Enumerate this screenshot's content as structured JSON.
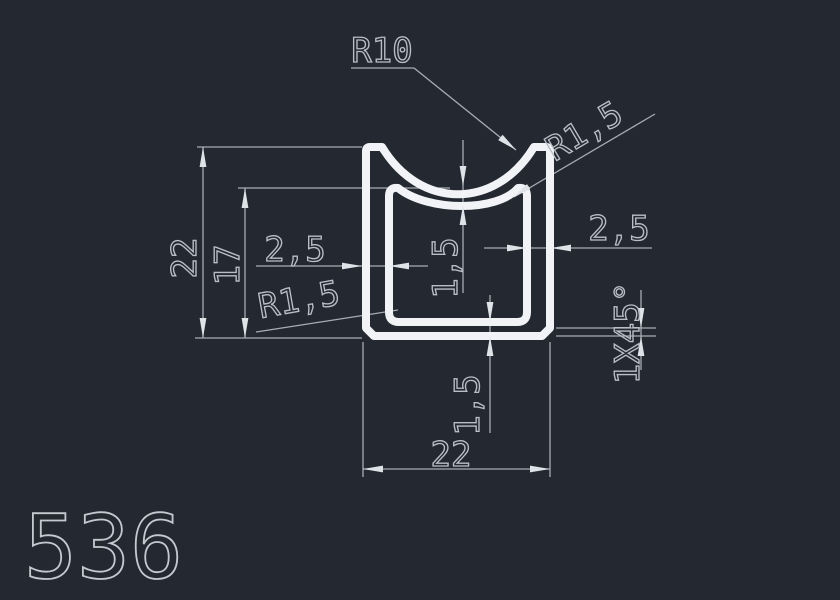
{
  "drawing": {
    "profile_number": "536",
    "dims": {
      "radius_saddle": "R10",
      "radius_top_right": "R1,5",
      "radius_bottom_left": "R1,5",
      "wall_left": "2,5",
      "wall_right": "2,5",
      "height_total": "22",
      "height_to_saddle": "17",
      "wall_top": "1,5",
      "wall_bottom": "1,5",
      "width_total": "22",
      "chamfer": "1X45°"
    },
    "colors": {
      "background": "#232831",
      "profile_line": "#f1f3f6",
      "dimension_line": "#a7adb5",
      "dimension_text": "#b9bfc7",
      "arrowhead": "#dfe3e8"
    }
  }
}
